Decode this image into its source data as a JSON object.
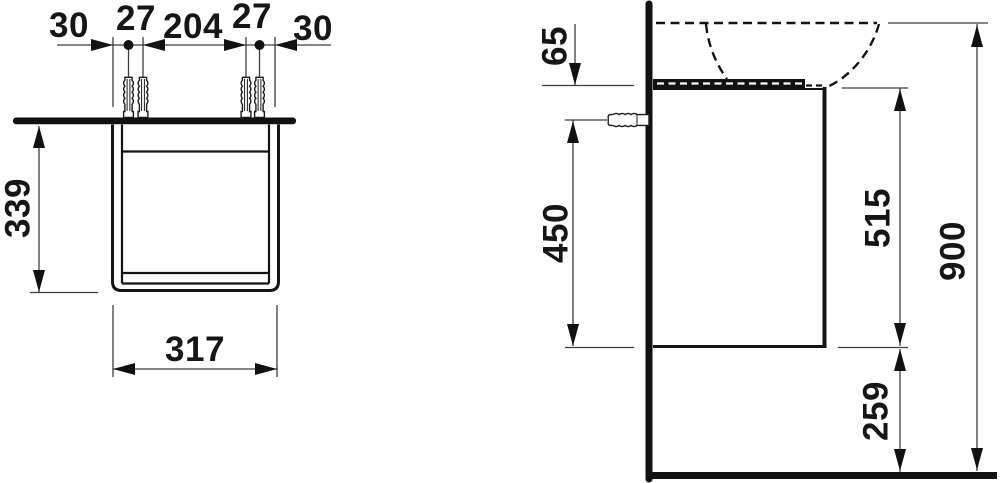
{
  "front_view": {
    "spacing_labels": [
      "30",
      "27",
      "204",
      "27",
      "30"
    ],
    "height_label": "339",
    "width_label": "317"
  },
  "side_view": {
    "rim_height_label": "65",
    "fixing_height_label": "450",
    "body_height_label": "515",
    "total_height_label": "900",
    "floor_clearance_label": "259"
  }
}
